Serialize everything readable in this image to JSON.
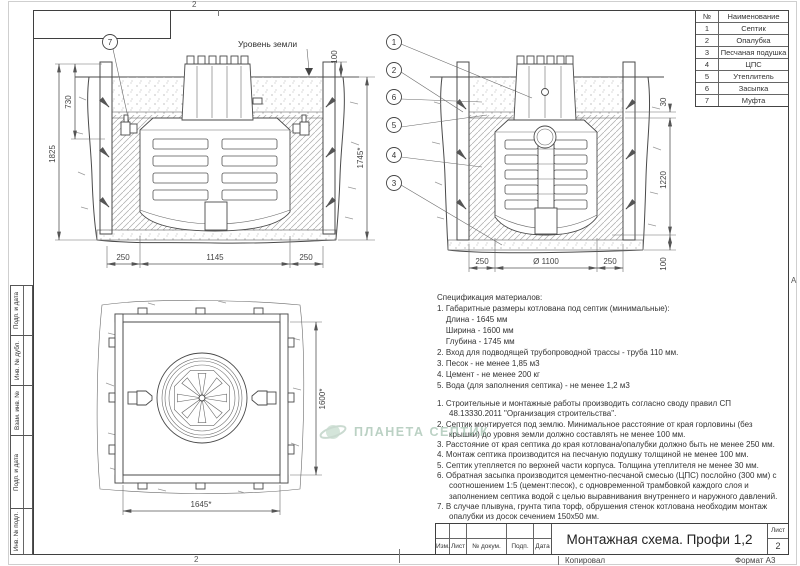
{
  "frame": {
    "zone_top": "2",
    "zone_bottom": "2",
    "zone_right": "А"
  },
  "parts_table": {
    "num_header": "№",
    "name_header": "Наименование",
    "rows": [
      {
        "num": "1",
        "name": "Септик"
      },
      {
        "num": "2",
        "name": "Опалубка"
      },
      {
        "num": "3",
        "name": "Песчаная подушка"
      },
      {
        "num": "4",
        "name": "ЦПС"
      },
      {
        "num": "5",
        "name": "Утеплитель"
      },
      {
        "num": "6",
        "name": "Засыпка"
      },
      {
        "num": "7",
        "name": "Муфта"
      }
    ]
  },
  "d1": {
    "callout": "7",
    "ground_label": "Уровень земли",
    "dim_left": "1825",
    "dim_inner": "730",
    "dim_right": "1745*",
    "dim_top": "100",
    "dim_b1": "250",
    "dim_b2": "1145",
    "dim_b3": "250"
  },
  "d2": {
    "callouts": [
      "1",
      "2",
      "6",
      "5",
      "4",
      "3"
    ],
    "dim_r1": "30",
    "dim_r2": "1220",
    "dim_r3": "100",
    "dim_b1": "250",
    "dim_b2": "Ø 1100",
    "dim_b3": "250"
  },
  "d3": {
    "dim_right": "1600*",
    "dim_bottom": "1645*"
  },
  "spec": {
    "title": "Спецификация материалов:",
    "lines": [
      "1. Габаритные размеры котлована под септик (минимальные):",
      "    Длина - 1645 мм",
      "    Ширина - 1600 мм",
      "    Глубина - 1745 мм",
      "2. Вход для подводящей трубопроводной трассы - труба 110 мм.",
      "3. Песок - не менее 1,85 м3",
      "4. Цемент - не менее 200 кг",
      "5. Вода (для заполнения септика) - не менее 1,2 м3"
    ]
  },
  "notes": {
    "lines": [
      "1. Строительные и монтажные работы производить согласно своду правил СП 48.13330.2011 \"Организация строительства\".",
      "2. Септик монтируется под землю. Минимальное расстояние от края горловины (без крышки) до уровня земли должно составлять не менее 100 мм.",
      "3. Расстояние от края септика до края котлована/опалубки должно быть не менее 250 мм.",
      "4. Монтаж септика производится на песчаную подушку толщиной не менее 100 мм.",
      "5. Септик утепляется по верхней части корпуса. Толщина утеплителя не менее 30 мм.",
      "6. Обратная засыпка производится цементно-песчаной смесью (ЦПС) послойно (300 мм) с соотношением 1:5 (цемент:песок), с одновременной трамбовкой каждого слоя и заполнением септика водой с целью выравнивания внутреннего и наружного давлений.",
      "7. В случае плывуна, грунта типа торф, обрушения стенок котлована необходим монтаж опалубки из досок сечением 150x50 мм."
    ]
  },
  "sidebar": {
    "labels": [
      "Подп. и дата",
      "Инв. № дубл.",
      "Взам. инв. №",
      "Подп. и дата",
      "Инв. № подл."
    ]
  },
  "titleblock": {
    "title": "Монтажная схема. Профи 1,2",
    "cols": [
      "Изм.",
      "Лист",
      "№ докум.",
      "Подп.",
      "Дата"
    ],
    "sheet_label": "Лист",
    "sheet_number": "2",
    "copied": "Копировал",
    "format": "Формат А3"
  },
  "watermark": {
    "text": "ПЛАНЕТА СЕПТИК"
  }
}
